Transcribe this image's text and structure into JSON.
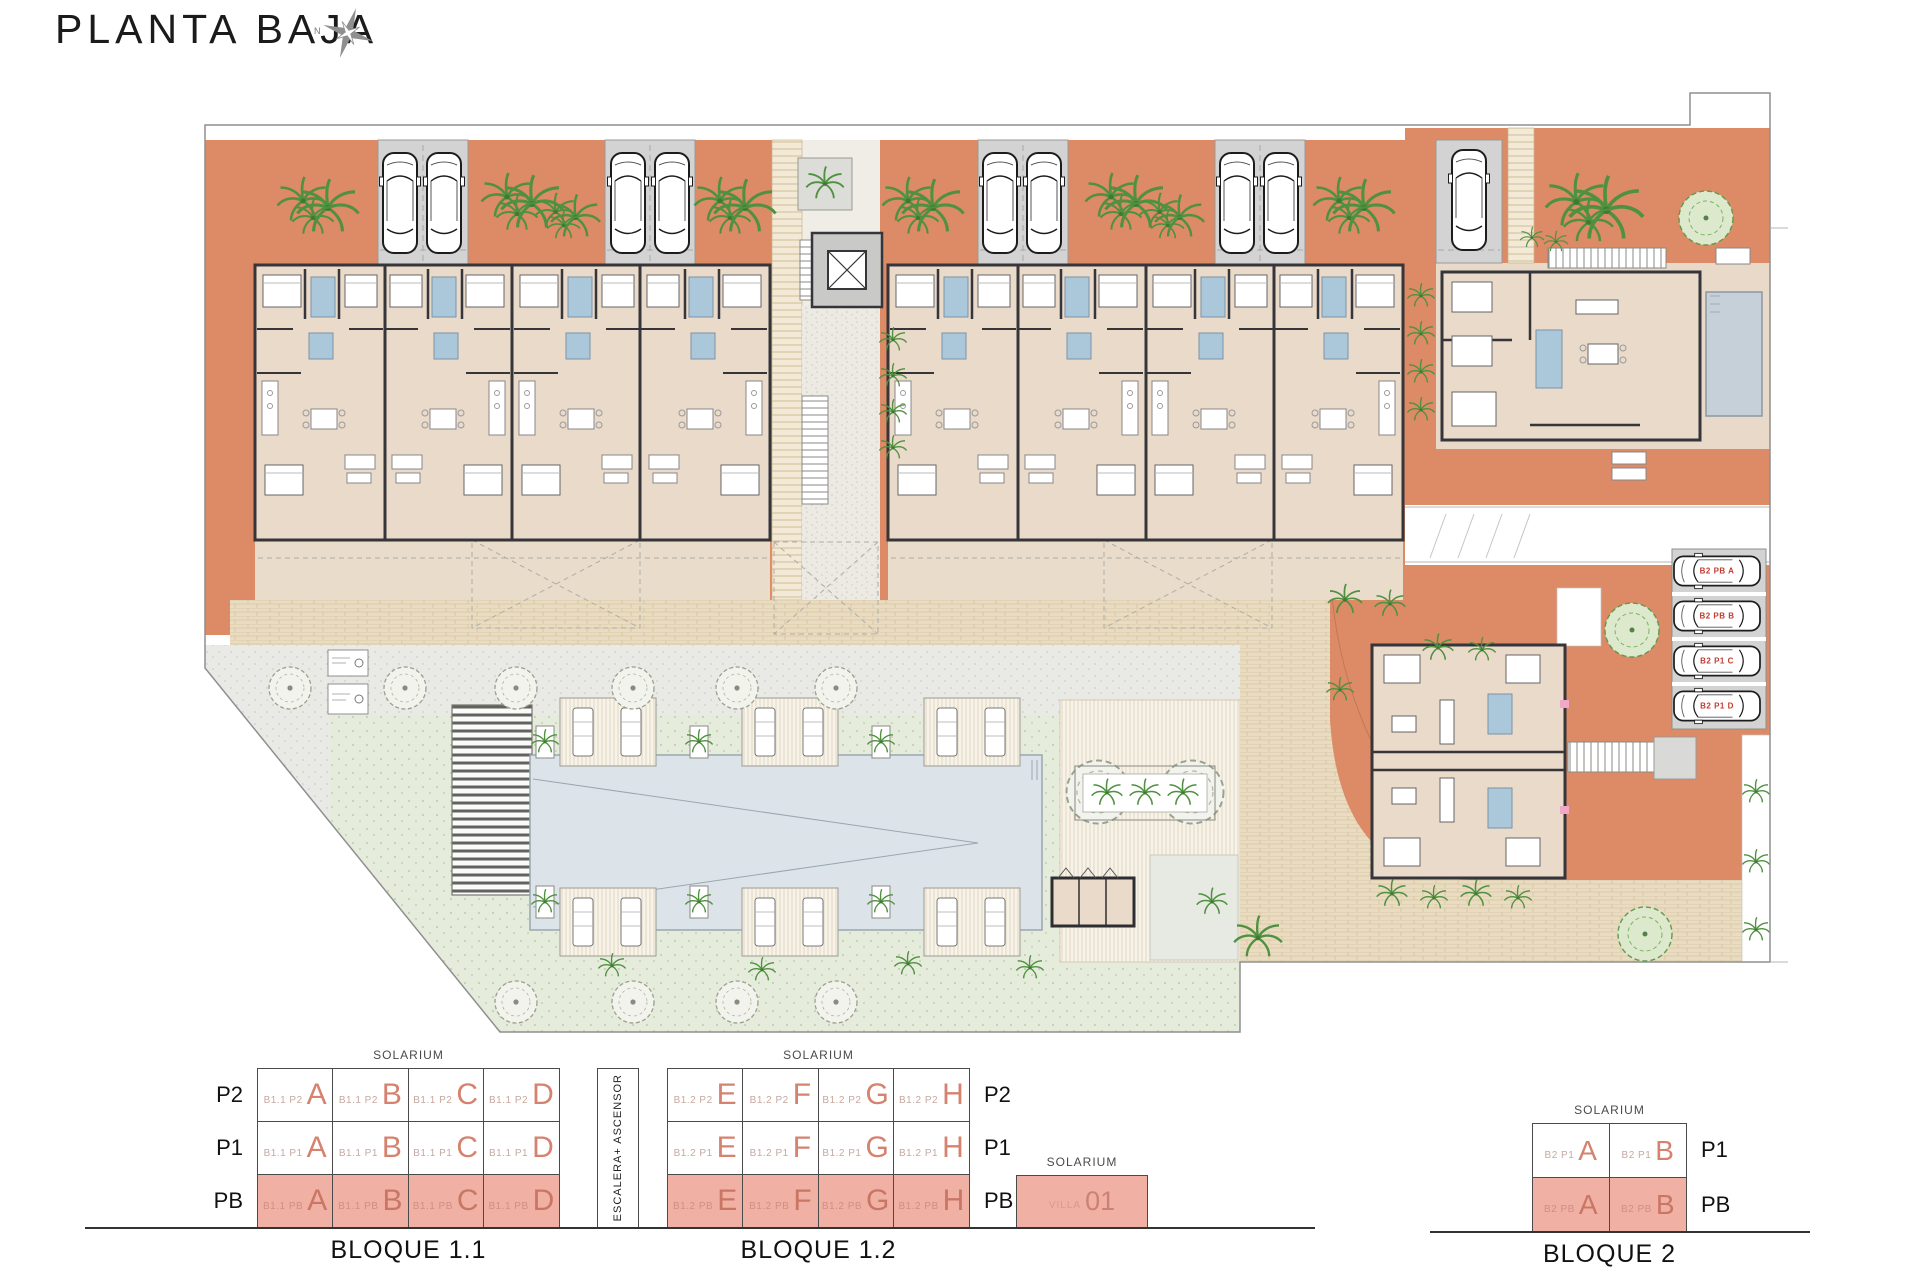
{
  "title": "PLANTA BAJA",
  "compass": {
    "label": "N"
  },
  "site": {
    "parking_labels": [
      "B2 PB A",
      "B2 PB B",
      "B2 P1 C",
      "B2 P1 D"
    ]
  },
  "legend": {
    "solarium_label": "SOLARIUM",
    "escalera_label": "ESCALERA+ ASCENSOR",
    "bloque11": {
      "title": "BLOQUE 1.1",
      "rows": [
        {
          "floor": "P2",
          "cells": [
            {
              "code": "B1.1 P2",
              "letter": "A"
            },
            {
              "code": "B1.1 P2",
              "letter": "B"
            },
            {
              "code": "B1.1 P2",
              "letter": "C"
            },
            {
              "code": "B1.1 P2",
              "letter": "D"
            }
          ]
        },
        {
          "floor": "P1",
          "cells": [
            {
              "code": "B1.1 P1",
              "letter": "A"
            },
            {
              "code": "B1.1 P1",
              "letter": "B"
            },
            {
              "code": "B1.1 P1",
              "letter": "C"
            },
            {
              "code": "B1.1 P1",
              "letter": "D"
            }
          ]
        },
        {
          "floor": "PB",
          "cells": [
            {
              "code": "B1.1 PB",
              "letter": "A"
            },
            {
              "code": "B1.1 PB",
              "letter": "B"
            },
            {
              "code": "B1.1 PB",
              "letter": "C"
            },
            {
              "code": "B1.1 PB",
              "letter": "D"
            }
          ]
        }
      ]
    },
    "bloque12": {
      "title": "BLOQUE 1.2",
      "rows": [
        {
          "floor": "P2",
          "cells": [
            {
              "code": "B1.2 P2",
              "letter": "E"
            },
            {
              "code": "B1.2 P2",
              "letter": "F"
            },
            {
              "code": "B1.2 P2",
              "letter": "G"
            },
            {
              "code": "B1.2 P2",
              "letter": "H"
            }
          ]
        },
        {
          "floor": "P1",
          "cells": [
            {
              "code": "B1.2 P1",
              "letter": "E"
            },
            {
              "code": "B1.2 P1",
              "letter": "F"
            },
            {
              "code": "B1.2 P1",
              "letter": "G"
            },
            {
              "code": "B1.2 P1",
              "letter": "H"
            }
          ]
        },
        {
          "floor": "PB",
          "cells": [
            {
              "code": "B1.2 PB",
              "letter": "E"
            },
            {
              "code": "B1.2 PB",
              "letter": "F"
            },
            {
              "code": "B1.2 PB",
              "letter": "G"
            },
            {
              "code": "B1.2 PB",
              "letter": "H"
            }
          ]
        }
      ]
    },
    "villa": {
      "code": "VILLA",
      "number": "01"
    },
    "bloque2": {
      "title": "BLOQUE 2",
      "rows": [
        {
          "floor": "P1",
          "cells": [
            {
              "code": "B2 P1",
              "letter": "A"
            },
            {
              "code": "B2 P1",
              "letter": "B"
            }
          ]
        },
        {
          "floor": "PB",
          "cells": [
            {
              "code": "B2 PB",
              "letter": "A"
            },
            {
              "code": "B2 PB",
              "letter": "B"
            }
          ]
        }
      ]
    }
  },
  "colors": {
    "terracotta": "#DD8A66",
    "building_beige": "#EADACA",
    "wall": "#35353A",
    "bath_blue": "#ABC7DA",
    "garage_gray": "#D3D3D3",
    "lawn_green": "#E6ECDC",
    "pool_blue": "#DCE4E9",
    "legend_pink": "#F1B0A4",
    "unit_letter_salmon": "#D5826F",
    "parking_label_red": "#C23B30"
  }
}
